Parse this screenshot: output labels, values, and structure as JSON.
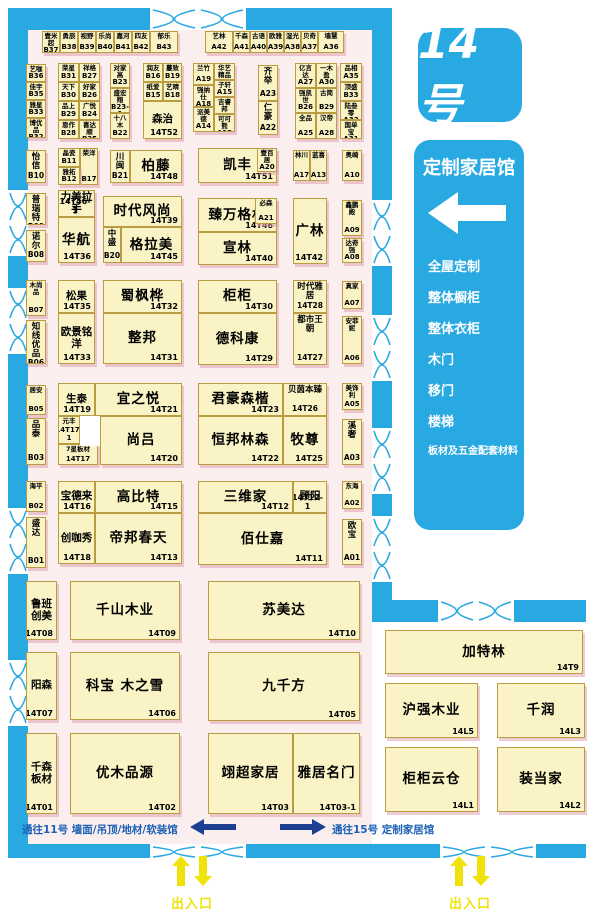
{
  "hall": {
    "badge": "14号"
  },
  "panel": {
    "title": "定制家居馆",
    "categories": [
      "全屋定制",
      "整体橱柜",
      "整体衣柜",
      "木门",
      "移门",
      "楼梯",
      "板材及五金配套材料"
    ]
  },
  "passages": {
    "to11": "通往11号 墙面/吊顶/地材/软装馆",
    "to15": "通往15号 定制家居馆"
  },
  "entrance_label": "出入口",
  "colors": {
    "accent_blue": "#29a9e1",
    "navy_arrow": "#1d3f92",
    "passage_text_blue": "#1b61b6",
    "booth_fill": "#faf3c5",
    "booth_border": "#ba9c42",
    "floor_pink": "#fbeeee",
    "entrance_yellow": "#efe30b"
  },
  "booths": [
    {
      "name": "壹米超",
      "id": "B37",
      "x": 42,
      "y": 31,
      "w": 18,
      "h": 22,
      "tier": "xs"
    },
    {
      "name": "勇辰",
      "id": "B38",
      "x": 60,
      "y": 31,
      "w": 18,
      "h": 22,
      "tier": "xs"
    },
    {
      "name": "视野",
      "id": "B39",
      "x": 78,
      "y": 31,
      "w": 18,
      "h": 22,
      "tier": "xs"
    },
    {
      "name": "乐尚",
      "id": "B40",
      "x": 96,
      "y": 31,
      "w": 18,
      "h": 22,
      "tier": "xs"
    },
    {
      "name": "嘉河",
      "id": "B41",
      "x": 114,
      "y": 31,
      "w": 18,
      "h": 22,
      "tier": "xs"
    },
    {
      "name": "四友",
      "id": "B42",
      "x": 132,
      "y": 31,
      "w": 18,
      "h": 22,
      "tier": "xs"
    },
    {
      "name": "郁乐",
      "id": "B43",
      "x": 150,
      "y": 31,
      "w": 28,
      "h": 22,
      "tier": "xs"
    },
    {
      "name": "艺林",
      "id": "A42",
      "x": 205,
      "y": 31,
      "w": 28,
      "h": 22,
      "tier": "xs"
    },
    {
      "name": "千森",
      "id": "A41",
      "x": 233,
      "y": 31,
      "w": 17,
      "h": 22,
      "tier": "xs"
    },
    {
      "name": "古语",
      "id": "A40",
      "x": 250,
      "y": 31,
      "w": 17,
      "h": 22,
      "tier": "xs"
    },
    {
      "name": "欧雅",
      "id": "A39",
      "x": 267,
      "y": 31,
      "w": 17,
      "h": 22,
      "tier": "xs"
    },
    {
      "name": "湿光",
      "id": "A38",
      "x": 284,
      "y": 31,
      "w": 17,
      "h": 22,
      "tier": "xs"
    },
    {
      "name": "贝奇",
      "id": "A37",
      "x": 301,
      "y": 31,
      "w": 17,
      "h": 22,
      "tier": "xs"
    },
    {
      "name": "墙慧",
      "id": "A36",
      "x": 318,
      "y": 31,
      "w": 26,
      "h": 22,
      "tier": "xs"
    },
    {
      "name": "艺咖",
      "id": "B36",
      "x": 26,
      "y": 64,
      "w": 20,
      "h": 18,
      "tier": "xs"
    },
    {
      "name": "佳宇",
      "id": "B35",
      "x": 26,
      "y": 82,
      "w": 20,
      "h": 18,
      "tier": "xs"
    },
    {
      "name": "雅星",
      "id": "B33",
      "x": 26,
      "y": 100,
      "w": 20,
      "h": 18,
      "tier": "xs"
    },
    {
      "name": "博优品",
      "id": "B32",
      "x": 26,
      "y": 118,
      "w": 20,
      "h": 20,
      "tier": "xs"
    },
    {
      "name": "荣星",
      "id": "B31",
      "x": 58,
      "y": 63,
      "w": 21,
      "h": 19,
      "tier": "xs"
    },
    {
      "name": "祥格",
      "id": "B27",
      "x": 79,
      "y": 63,
      "w": 21,
      "h": 19,
      "tier": "xs"
    },
    {
      "name": "天下",
      "id": "B30",
      "x": 58,
      "y": 82,
      "w": 21,
      "h": 19,
      "tier": "xs"
    },
    {
      "name": "好家",
      "id": "B26",
      "x": 79,
      "y": 82,
      "w": 21,
      "h": 19,
      "tier": "xs"
    },
    {
      "name": "品上",
      "id": "B29",
      "x": 58,
      "y": 101,
      "w": 21,
      "h": 19,
      "tier": "xs"
    },
    {
      "name": "广悦",
      "id": "B24",
      "x": 79,
      "y": 101,
      "w": 21,
      "h": 19,
      "tier": "xs"
    },
    {
      "name": "恩作",
      "id": "B28",
      "x": 58,
      "y": 120,
      "w": 21,
      "h": 19,
      "tier": "xs"
    },
    {
      "name": "喜达顺",
      "id": "B25",
      "x": 79,
      "y": 120,
      "w": 21,
      "h": 19,
      "tier": "xs"
    },
    {
      "name": "对家高",
      "id": "B23",
      "x": 110,
      "y": 63,
      "w": 20,
      "h": 25,
      "tier": "xs"
    },
    {
      "name": "盛宏翔",
      "id": "B23-1",
      "x": 110,
      "y": 88,
      "w": 20,
      "h": 25,
      "tier": "xs"
    },
    {
      "name": "十八木",
      "id": "B22",
      "x": 110,
      "y": 113,
      "w": 20,
      "h": 26,
      "tier": "xs"
    },
    {
      "name": "润友",
      "id": "B16",
      "x": 143,
      "y": 63,
      "w": 20,
      "h": 19,
      "tier": "xs"
    },
    {
      "name": "蔓致",
      "id": "B19",
      "x": 163,
      "y": 63,
      "w": 19,
      "h": 19,
      "tier": "xs"
    },
    {
      "name": "纸爱",
      "id": "B15",
      "x": 143,
      "y": 82,
      "w": 20,
      "h": 19,
      "tier": "xs"
    },
    {
      "name": "艺晴",
      "id": "B18",
      "x": 163,
      "y": 82,
      "w": 19,
      "h": 19,
      "tier": "xs"
    },
    {
      "name": "森治",
      "id": "14T52",
      "x": 143,
      "y": 101,
      "w": 39,
      "h": 38,
      "tier": "md"
    },
    {
      "name": "兰竹",
      "id": "A19",
      "x": 193,
      "y": 63,
      "w": 21,
      "h": 22,
      "tier": "xs"
    },
    {
      "name": "华艺精品",
      "id": "A16",
      "x": 214,
      "y": 63,
      "w": 21,
      "h": 17,
      "tier": "xs"
    },
    {
      "name": "强纳仕",
      "id": "A18",
      "x": 193,
      "y": 85,
      "w": 21,
      "h": 22,
      "tier": "xs"
    },
    {
      "name": "子轩",
      "id": "A15",
      "x": 214,
      "y": 80,
      "w": 21,
      "h": 17,
      "tier": "xs"
    },
    {
      "name": "派美德",
      "id": "A14",
      "x": 193,
      "y": 107,
      "w": 21,
      "h": 25,
      "tier": "xs"
    },
    {
      "name": "吉睿邦",
      "id": "A11",
      "x": 214,
      "y": 97,
      "w": 21,
      "h": 17,
      "tier": "xs"
    },
    {
      "name": "可可熊",
      "id": "A12",
      "x": 214,
      "y": 114,
      "w": 21,
      "h": 18,
      "tier": "xs"
    },
    {
      "name": "齐举",
      "id": "A23",
      "x": 258,
      "y": 65,
      "w": 20,
      "h": 36,
      "tier": "sm"
    },
    {
      "name": "仁豪",
      "id": "A22",
      "x": 258,
      "y": 101,
      "w": 20,
      "h": 34,
      "tier": "sm"
    },
    {
      "name": "亿言达",
      "id": "A27",
      "x": 295,
      "y": 63,
      "w": 21,
      "h": 25,
      "tier": "xs"
    },
    {
      "name": "一木盈",
      "id": "A30",
      "x": 316,
      "y": 63,
      "w": 21,
      "h": 25,
      "tier": "xs"
    },
    {
      "name": "强凯世",
      "id": "B26",
      "x": 295,
      "y": 88,
      "w": 21,
      "h": 25,
      "tier": "xs"
    },
    {
      "name": "古简",
      "id": "B29",
      "x": 316,
      "y": 88,
      "w": 21,
      "h": 25,
      "tier": "xs"
    },
    {
      "name": "全品",
      "id": "A25",
      "x": 295,
      "y": 113,
      "w": 21,
      "h": 26,
      "tier": "xs"
    },
    {
      "name": "汉帝",
      "id": "A28",
      "x": 316,
      "y": 113,
      "w": 21,
      "h": 26,
      "tier": "xs"
    },
    {
      "name": "品相",
      "id": "A35",
      "x": 340,
      "y": 63,
      "w": 22,
      "h": 19,
      "tier": "xs"
    },
    {
      "name": "顶盛",
      "id": "B33",
      "x": 340,
      "y": 82,
      "w": 22,
      "h": 19,
      "tier": "xs"
    },
    {
      "name": "陆叁零",
      "id": "A32",
      "x": 340,
      "y": 101,
      "w": 22,
      "h": 19,
      "tier": "xs"
    },
    {
      "name": "国单宝",
      "id": "A31",
      "x": 340,
      "y": 120,
      "w": 22,
      "h": 19,
      "tier": "xs"
    },
    {
      "name": "怡信",
      "id": "B10",
      "x": 26,
      "y": 150,
      "w": 20,
      "h": 33,
      "tier": "sm"
    },
    {
      "name": "晶瓷",
      "id": "B11",
      "x": 58,
      "y": 148,
      "w": 22,
      "h": 19,
      "tier": "xs"
    },
    {
      "name": "荣洋",
      "id": "B17",
      "x": 80,
      "y": 148,
      "w": 18,
      "h": 37,
      "tier": "xs"
    },
    {
      "name": "雅拓",
      "id": "B12",
      "x": 58,
      "y": 167,
      "w": 22,
      "h": 18,
      "tier": "xs"
    },
    {
      "name": "川闽",
      "id": "B21",
      "x": 110,
      "y": 150,
      "w": 20,
      "h": 33,
      "tier": "sm"
    },
    {
      "name": "柏藤",
      "id": "14T48",
      "x": 130,
      "y": 150,
      "w": 52,
      "h": 33,
      "tier": "lg"
    },
    {
      "name": "凯丰",
      "id": "14T51",
      "x": 198,
      "y": 148,
      "w": 79,
      "h": 35,
      "tier": "lg"
    },
    {
      "name": "壹百居",
      "id": "A20",
      "x": 257,
      "y": 148,
      "w": 20,
      "h": 24,
      "tier": "xs"
    },
    {
      "name": "林川",
      "id": "A17",
      "x": 293,
      "y": 150,
      "w": 17,
      "h": 31,
      "tier": "xs"
    },
    {
      "name": "蓝喜",
      "id": "A13",
      "x": 310,
      "y": 150,
      "w": 17,
      "h": 31,
      "tier": "xs"
    },
    {
      "name": "奥崎",
      "id": "A10",
      "x": 342,
      "y": 150,
      "w": 20,
      "h": 31,
      "tier": "xs"
    },
    {
      "name": "普瑞特",
      "id": "B09",
      "x": 26,
      "y": 193,
      "w": 20,
      "h": 32,
      "tier": "sm"
    },
    {
      "name": "诺尔",
      "id": "B08",
      "x": 26,
      "y": 230,
      "w": 20,
      "h": 32,
      "tier": "sm"
    },
    {
      "name": "力美拉手",
      "id": "14T46-1",
      "x": 58,
      "y": 190,
      "w": 37,
      "h": 27,
      "tier": "md"
    },
    {
      "name": "华航",
      "id": "14T36",
      "x": 58,
      "y": 217,
      "w": 37,
      "h": 46,
      "tier": "lg"
    },
    {
      "name": "时代风尚",
      "id": "14T39",
      "x": 103,
      "y": 196,
      "w": 79,
      "h": 31,
      "tier": "lg"
    },
    {
      "name": "中盛",
      "id": "B20",
      "x": 103,
      "y": 227,
      "w": 18,
      "h": 36,
      "tier": "sm"
    },
    {
      "name": "格拉美",
      "id": "14T45",
      "x": 121,
      "y": 227,
      "w": 61,
      "h": 36,
      "tier": "lg"
    },
    {
      "name": "臻万格林",
      "id": "14T46",
      "x": 198,
      "y": 198,
      "w": 79,
      "h": 34,
      "tier": "lg"
    },
    {
      "name": "必森",
      "id": "A21",
      "x": 255,
      "y": 198,
      "w": 22,
      "h": 26,
      "tier": "xs"
    },
    {
      "name": "宣林",
      "id": "14T40",
      "x": 198,
      "y": 232,
      "w": 79,
      "h": 33,
      "tier": "lg"
    },
    {
      "name": "广林",
      "id": "14T42",
      "x": 293,
      "y": 198,
      "w": 34,
      "h": 66,
      "tier": "lg"
    },
    {
      "name": "鑫鹏殿",
      "id": "A09",
      "x": 342,
      "y": 200,
      "w": 20,
      "h": 36,
      "tier": "xs"
    },
    {
      "name": "达奇强",
      "id": "A08",
      "x": 342,
      "y": 238,
      "w": 20,
      "h": 25,
      "tier": "xs"
    },
    {
      "name": "木尚品",
      "id": "B07",
      "x": 26,
      "y": 280,
      "w": 20,
      "h": 36,
      "tier": "xs"
    },
    {
      "name": "知线优品",
      "id": "B06",
      "x": 26,
      "y": 320,
      "w": 20,
      "h": 44,
      "tier": "sm"
    },
    {
      "name": "松果",
      "id": "14T35",
      "x": 58,
      "y": 280,
      "w": 37,
      "h": 33,
      "tier": "md"
    },
    {
      "name": "欧景铭洋",
      "id": "14T33",
      "x": 58,
      "y": 313,
      "w": 37,
      "h": 51,
      "tier": "md"
    },
    {
      "name": "蜀枫桦",
      "id": "14T32",
      "x": 103,
      "y": 280,
      "w": 79,
      "h": 33,
      "tier": "lg"
    },
    {
      "name": "整邦",
      "id": "14T31",
      "x": 103,
      "y": 313,
      "w": 79,
      "h": 51,
      "tier": "lg"
    },
    {
      "name": "柜柜",
      "id": "14T30",
      "x": 198,
      "y": 280,
      "w": 79,
      "h": 33,
      "tier": "lg"
    },
    {
      "name": "德科康",
      "id": "14T29",
      "x": 198,
      "y": 313,
      "w": 79,
      "h": 52,
      "tier": "lg"
    },
    {
      "name": "时代雅居",
      "id": "14T28",
      "x": 293,
      "y": 280,
      "w": 34,
      "h": 33,
      "tier": "sm"
    },
    {
      "name": "都市王朝",
      "id": "14T27",
      "x": 293,
      "y": 313,
      "w": 34,
      "h": 52,
      "tier": "sm"
    },
    {
      "name": "真家",
      "id": "A07",
      "x": 342,
      "y": 281,
      "w": 20,
      "h": 28,
      "tier": "xs"
    },
    {
      "name": "安菲妮",
      "id": "A06",
      "x": 342,
      "y": 316,
      "w": 20,
      "h": 48,
      "tier": "xs"
    },
    {
      "name": "居安",
      "id": "B05",
      "x": 26,
      "y": 385,
      "w": 20,
      "h": 30,
      "tier": "xs"
    },
    {
      "name": "品泰",
      "id": "B03",
      "x": 26,
      "y": 418,
      "w": 20,
      "h": 47,
      "tier": "sm"
    },
    {
      "name": "生泰",
      "id": "14T19",
      "x": 58,
      "y": 383,
      "w": 37,
      "h": 33,
      "tier": "md"
    },
    {
      "name": "宜之悦",
      "id": "14T21",
      "x": 95,
      "y": 383,
      "w": 87,
      "h": 33,
      "tier": "lg"
    },
    {
      "name": "元丰",
      "id": "14T17-1",
      "x": 58,
      "y": 416,
      "w": 22,
      "h": 28,
      "tier": "xs"
    },
    {
      "name": "7星板材",
      "id": "14T17",
      "x": 58,
      "y": 444,
      "w": 40,
      "h": 21,
      "tier": "xs"
    },
    {
      "name": "尚吕",
      "id": "14T20",
      "x": 100,
      "y": 416,
      "w": 82,
      "h": 49,
      "tier": "lg"
    },
    {
      "name": "君豪森楷",
      "id": "14T23",
      "x": 198,
      "y": 383,
      "w": 85,
      "h": 33,
      "tier": "lg"
    },
    {
      "name": "贝茵本臻",
      "id": "14T26",
      "x": 283,
      "y": 383,
      "w": 44,
      "h": 33,
      "tier": "sm"
    },
    {
      "name": "恒邦林森",
      "id": "14T22",
      "x": 198,
      "y": 416,
      "w": 85,
      "h": 49,
      "tier": "lg"
    },
    {
      "name": "牧尊",
      "id": "14T25",
      "x": 283,
      "y": 416,
      "w": 44,
      "h": 49,
      "tier": "lg"
    },
    {
      "name": "美饰利",
      "id": "A05",
      "x": 342,
      "y": 383,
      "w": 20,
      "h": 27,
      "tier": "xs"
    },
    {
      "name": "溪奢",
      "id": "A03",
      "x": 342,
      "y": 419,
      "w": 20,
      "h": 46,
      "tier": "sm"
    },
    {
      "name": "海平",
      "id": "B02",
      "x": 26,
      "y": 481,
      "w": 20,
      "h": 31,
      "tier": "xs"
    },
    {
      "name": "盛达",
      "id": "B01",
      "x": 26,
      "y": 517,
      "w": 20,
      "h": 51,
      "tier": "sm"
    },
    {
      "name": "宝德来",
      "id": "14T16",
      "x": 58,
      "y": 481,
      "w": 37,
      "h": 32,
      "tier": "md"
    },
    {
      "name": "高比特",
      "id": "14T15",
      "x": 95,
      "y": 481,
      "w": 87,
      "h": 32,
      "tier": "lg"
    },
    {
      "name": "创咖秀",
      "id": "14T18",
      "x": 58,
      "y": 513,
      "w": 37,
      "h": 51,
      "tier": "md"
    },
    {
      "name": "帝邦春天",
      "id": "14T13",
      "x": 95,
      "y": 513,
      "w": 87,
      "h": 51,
      "tier": "lg"
    },
    {
      "name": "三维家",
      "id": "14T12",
      "x": 198,
      "y": 481,
      "w": 95,
      "h": 32,
      "tier": "lg"
    },
    {
      "name": "顾阳",
      "id": "14T12-1",
      "x": 293,
      "y": 481,
      "w": 34,
      "h": 32,
      "tier": "md"
    },
    {
      "name": "佰仕嘉",
      "id": "14T11",
      "x": 198,
      "y": 513,
      "w": 129,
      "h": 52,
      "tier": "lg"
    },
    {
      "name": "东海",
      "id": "A02",
      "x": 342,
      "y": 481,
      "w": 20,
      "h": 28,
      "tier": "xs"
    },
    {
      "name": "欧宝",
      "id": "A01",
      "x": 342,
      "y": 519,
      "w": 20,
      "h": 46,
      "tier": "sm"
    },
    {
      "name": "鲁班创美",
      "id": "14T08",
      "x": 26,
      "y": 581,
      "w": 31,
      "h": 59,
      "tier": "md"
    },
    {
      "name": "千山木业",
      "id": "14T09",
      "x": 70,
      "y": 581,
      "w": 110,
      "h": 59,
      "tier": "lg"
    },
    {
      "name": "阳森",
      "id": "14T07",
      "x": 26,
      "y": 652,
      "w": 31,
      "h": 68,
      "tier": "md"
    },
    {
      "name": "科宝  木之雪",
      "id": "14T06",
      "x": 70,
      "y": 652,
      "w": 110,
      "h": 68,
      "tier": "lg"
    },
    {
      "name": "苏美达",
      "id": "14T10",
      "x": 208,
      "y": 581,
      "w": 152,
      "h": 59,
      "tier": "lg"
    },
    {
      "name": "九千方",
      "id": "14T05",
      "x": 208,
      "y": 652,
      "w": 152,
      "h": 69,
      "tier": "lg"
    },
    {
      "name": "千森板材",
      "id": "14T01",
      "x": 26,
      "y": 733,
      "w": 31,
      "h": 81,
      "tier": "md"
    },
    {
      "name": "优木品源",
      "id": "14T02",
      "x": 70,
      "y": 733,
      "w": 110,
      "h": 81,
      "tier": "lg"
    },
    {
      "name": "翊超家居",
      "id": "14T03",
      "x": 208,
      "y": 733,
      "w": 85,
      "h": 81,
      "tier": "lg"
    },
    {
      "name": "雅居名门",
      "id": "14T03-1",
      "x": 293,
      "y": 733,
      "w": 67,
      "h": 81,
      "tier": "lg"
    },
    {
      "name": "加特林",
      "id": "14T9",
      "x": 385,
      "y": 630,
      "w": 198,
      "h": 44,
      "tier": "lg"
    },
    {
      "name": "沪强木业",
      "id": "14L5",
      "x": 385,
      "y": 683,
      "w": 93,
      "h": 55,
      "tier": "lg"
    },
    {
      "name": "千润",
      "id": "14L3",
      "x": 497,
      "y": 683,
      "w": 88,
      "h": 55,
      "tier": "lg"
    },
    {
      "name": "柜柜云仓",
      "id": "14L1",
      "x": 385,
      "y": 747,
      "w": 93,
      "h": 65,
      "tier": "lg"
    },
    {
      "name": "装当家",
      "id": "14L2",
      "x": 497,
      "y": 747,
      "w": 88,
      "h": 65,
      "tier": "lg"
    }
  ]
}
